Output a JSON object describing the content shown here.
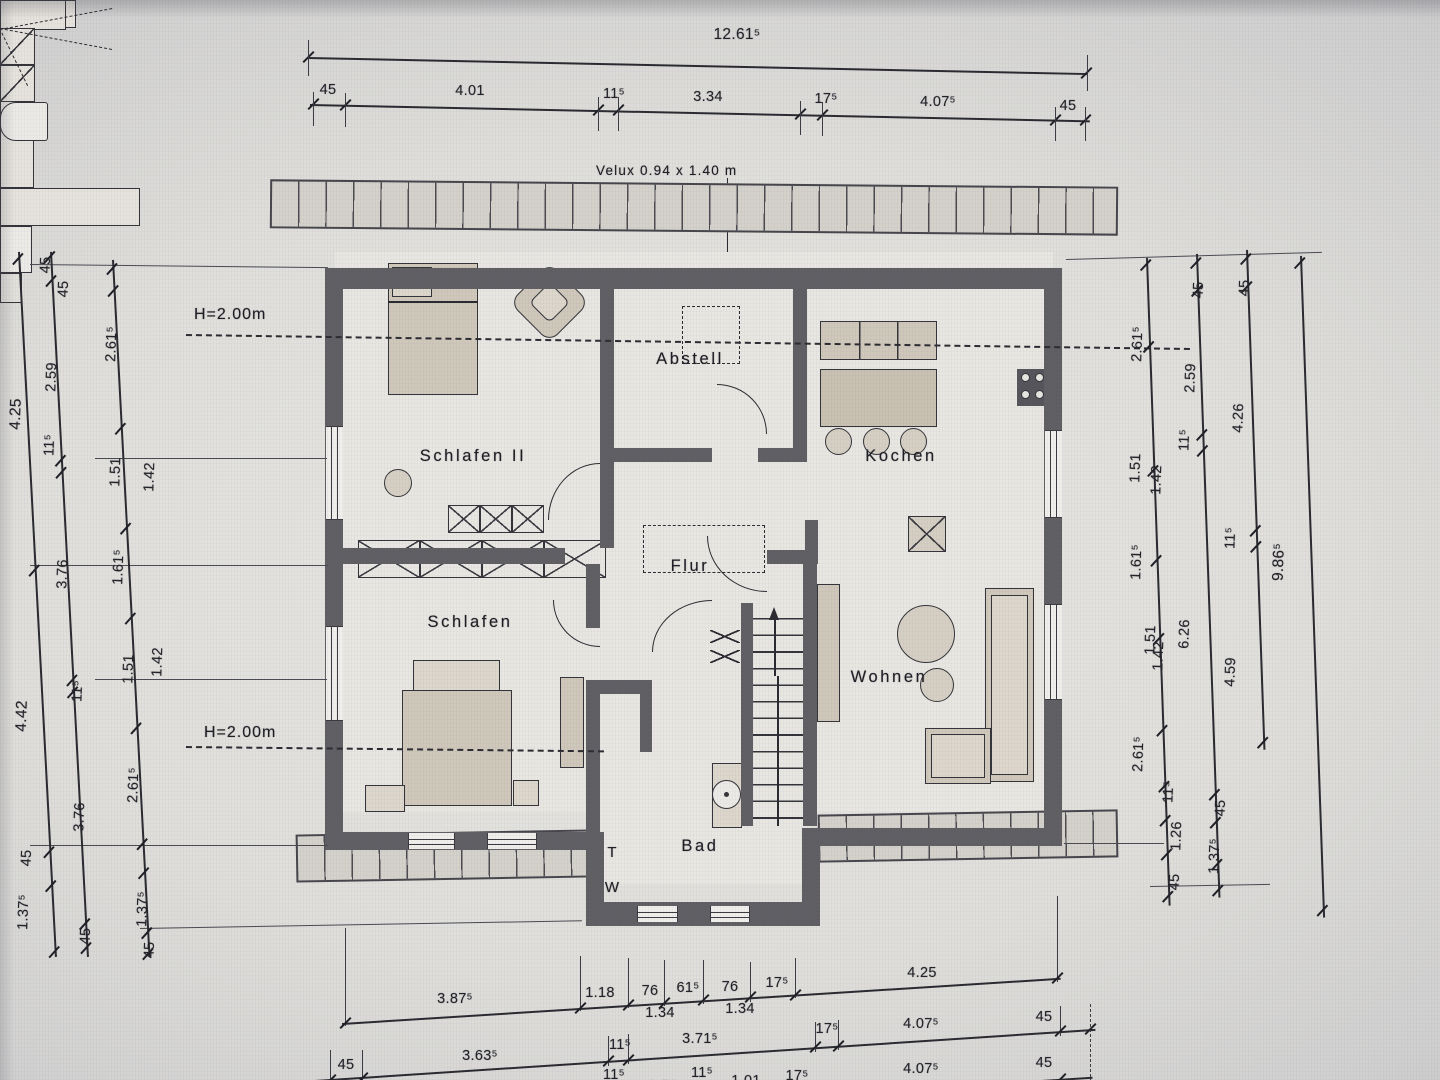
{
  "note_velux": "Velux 0.94 x 1.40 m",
  "height_marks": {
    "upper": "H=2.00m",
    "lower": "H=2.00m"
  },
  "rooms": {
    "schlafen2": "Schlafen II",
    "abstell": "Abstell",
    "kochen": "Kochen",
    "flur": "Flur",
    "schlafen": "Schlafen",
    "wohnen": "Wohnen",
    "bad": "Bad"
  },
  "appliance_labels": {
    "dryer": "T",
    "washer": "W"
  },
  "dims": {
    "top": {
      "overall": "12.61⁵",
      "segments": [
        "45",
        "4.01",
        "11⁵",
        "3.34",
        "17⁵",
        "4.07⁵",
        "45"
      ]
    },
    "bottom": {
      "row1": [
        "3.87⁵",
        "1.18",
        "76",
        "1.34",
        "61⁵",
        "76",
        "1.34",
        "17⁵",
        "4.25"
      ],
      "row2": [
        "45",
        "3.63⁵",
        "11⁵",
        "3.71⁵",
        "17⁵",
        "4.07⁵",
        "45"
      ],
      "row3": [
        "3.63⁵",
        "11⁵",
        "88⁵",
        "11⁵",
        "1.59",
        "11⁵",
        "1.01",
        "17⁵",
        "4.07⁵",
        "45"
      ]
    },
    "left": {
      "col1": [
        "4.25",
        "4.42",
        "45",
        "1.37⁵"
      ],
      "col2": [
        "45",
        "2.59",
        "11⁵",
        "3.76",
        "11⁵",
        "3.76",
        "45"
      ],
      "col3": [
        "45",
        "2.61⁵",
        "1.51",
        "1.42",
        "1.61⁵",
        "1.51",
        "1.42",
        "2.61⁵",
        "1.37⁵",
        "45"
      ]
    },
    "right": {
      "col1": [
        "2.61⁵",
        "1.51",
        "1.42",
        "1.61⁵",
        "1.51",
        "1.42",
        "2.61⁵",
        "11⁵",
        "1.26",
        "45"
      ],
      "col2": [
        "45",
        "2.59",
        "11⁵",
        "6.26",
        "45",
        "1.37⁵"
      ],
      "col3": [
        "45",
        "4.26",
        "11⁵",
        "4.59"
      ],
      "col4": [
        "9.86⁵"
      ]
    }
  }
}
